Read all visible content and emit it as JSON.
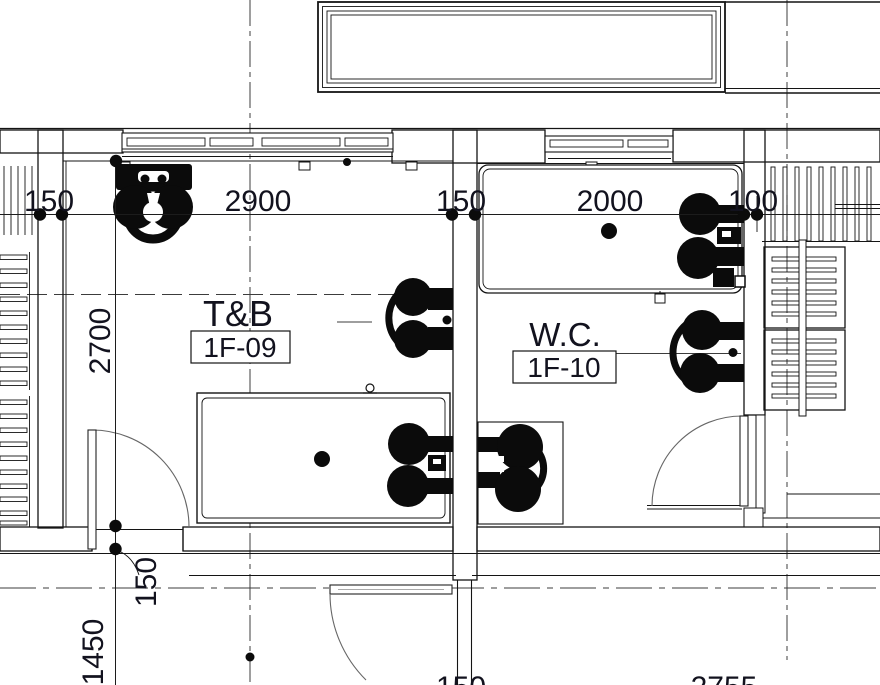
{
  "drawing": {
    "type": "architectural-floor-plan",
    "rooms": [
      {
        "name": "T&B",
        "code": "1F-09"
      },
      {
        "name": "W.C.",
        "code": "1F-10"
      }
    ],
    "dims_top": [
      "150",
      "2900",
      "150",
      "2000",
      "100"
    ],
    "dims_left": [
      "2700",
      "150",
      "1450"
    ],
    "dims_bottom": [
      "150",
      "2755"
    ],
    "colors": {
      "line": "#141414",
      "hatch": "#7a7a7a",
      "text": "#12121e",
      "background": "#ffffff"
    }
  }
}
